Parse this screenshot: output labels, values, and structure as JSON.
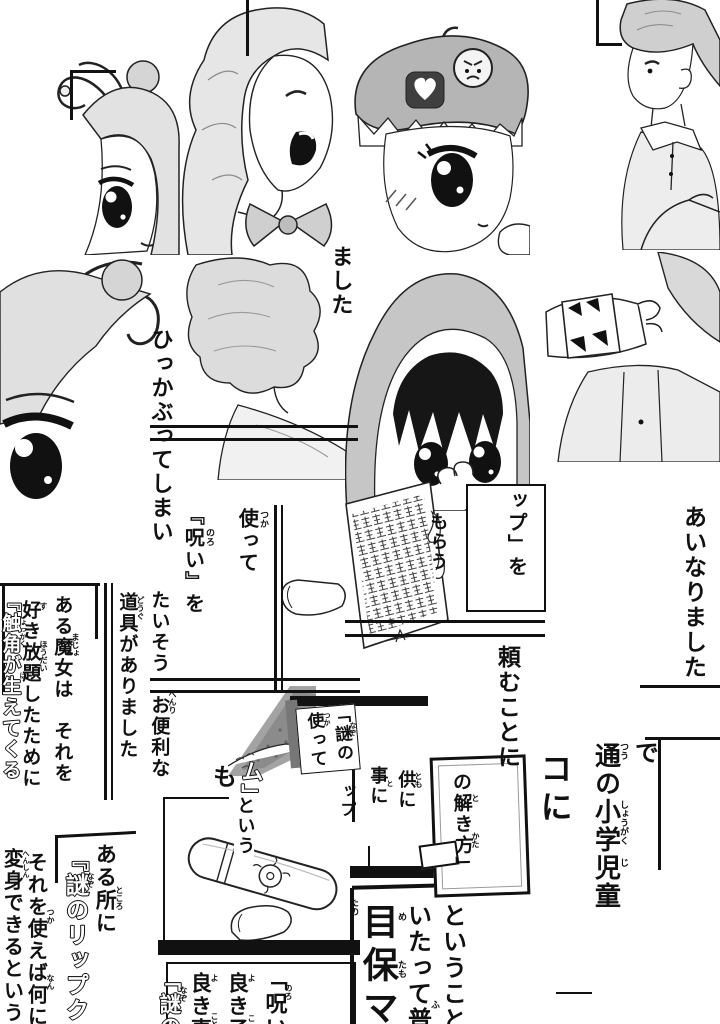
{
  "colors": {
    "paper": "#ffffff",
    "ink": "#111111",
    "tone_light": "#e2e2e2",
    "tone_mid": "#c6c6c6",
    "tone_dark": "#4a4a4a"
  },
  "fragments": {
    "hikkabutte": {
      "text": "ひっかぶってしまい"
    },
    "mashita": {
      "text": "ました"
    },
    "tsukatte": {
      "text": "使って",
      "ruby": "つか"
    },
    "noroi_wo": {
      "text": "『呪い』を",
      "ruby": "のろ"
    },
    "taisou": {
      "text": "たいそう　お便利な",
      "ruby": "べんり"
    },
    "dougu": {
      "text": "道具がありました",
      "ruby": "どうぐ"
    },
    "majo": {
      "text": "ある魔女は　それを",
      "ruby": "まじょ"
    },
    "sukihoudai": {
      "text": "好き放題したために",
      "ruby_1": "す",
      "ruby_2": "ほうだい"
    },
    "shokkaku": {
      "text": "『触角が生えてくる",
      "ruby_1": "しょっかく",
      "ruby_2": "は"
    },
    "morau": {
      "text": "もらう"
    },
    "rippu_wo": {
      "text": "ップ」を"
    },
    "tanomu": {
      "text": "頼むことに"
    },
    "ainari": {
      "text": "あいなりました"
    },
    "de": {
      "text": "で"
    },
    "shougaku": {
      "text": "通の小学児童",
      "ruby_1": "つう",
      "ruby_2": "しょうがく",
      "ruby_3": "じ"
    },
    "ko_ni": {
      "text": "コに"
    },
    "sign_tsukatte": {
      "text": "使って",
      "ruby": "つか"
    },
    "sign_nazono": {
      "text": "「謎の",
      "ruby": "なぞ"
    },
    "sign_ppu": {
      "text": "ップ"
    },
    "tokikata": {
      "text": "の解き方」",
      "ruby_1": "と",
      "ruby_2": "かた"
    },
    "tomo_ni": {
      "text": "供に",
      "ruby": "とも"
    },
    "koto_ni": {
      "text": "事に",
      "ruby": "と"
    },
    "to_iu": {
      "text": "という"
    },
    "mo": {
      "text": "も"
    },
    "mu": {
      "text": "ム」"
    },
    "aru_tokoro": {
      "text": "ある所に",
      "ruby": "ところ"
    },
    "nazo_rippu": {
      "text": "『謎のリップク",
      "ruby": "なぞ"
    },
    "sore_wo": {
      "text": "それを使えば何にで",
      "ruby_1": "つか",
      "ruby_2": "なん"
    },
    "henshin": {
      "text": "変身できるという",
      "ruby": "へんしん"
    },
    "toiukoto": {
      "text": "ということ"
    },
    "itatte": {
      "text": "いたって普",
      "ruby": "ふ"
    },
    "metamo": {
      "text": "目保マ",
      "ruby_1": "め",
      "ruby_2": "たも"
    },
    "tano": {
      "text": "たの"
    },
    "noroi_panel": {
      "text": "「呪い",
      "ruby": "のろ"
    },
    "yoki_ko": {
      "text": "良き子",
      "ruby_1": "よ",
      "ruby_2": "こ"
    },
    "yoki_koto": {
      "text": "良き事",
      "ruby_1": "よ",
      "ruby_2": "こと"
    },
    "nazo_panel": {
      "text": "「謎の",
      "ruby": "なぞ"
    }
  },
  "artwork": {
    "antenna_girl_top": "girl with curling antennae and hair bun",
    "wavy_hair_girl": "laughing girl with wavy hair and chest ribbon",
    "beret_girl": "girl in toothed beret with heart and sad-face badges",
    "boy_polo": "boy in polo shirt with arm raised",
    "antenna_girl_closeup": "close-up of antenna girl's large eye",
    "back_of_head_girl": "back of girl's wavy hair and shoulder",
    "hooded_girl": "wide-eyed girl in hood holding page",
    "bracelet_arm": "raised arm with fanged bracelet and vest",
    "spell_book_page": "tilted page densely covered in strange glyphs",
    "screentone_corner": "screentone shaded corner behind small sign",
    "lip_cream_tube": "tube of the mysterious lip cream",
    "small_thumb": "thumb at corner of bottom panel"
  }
}
